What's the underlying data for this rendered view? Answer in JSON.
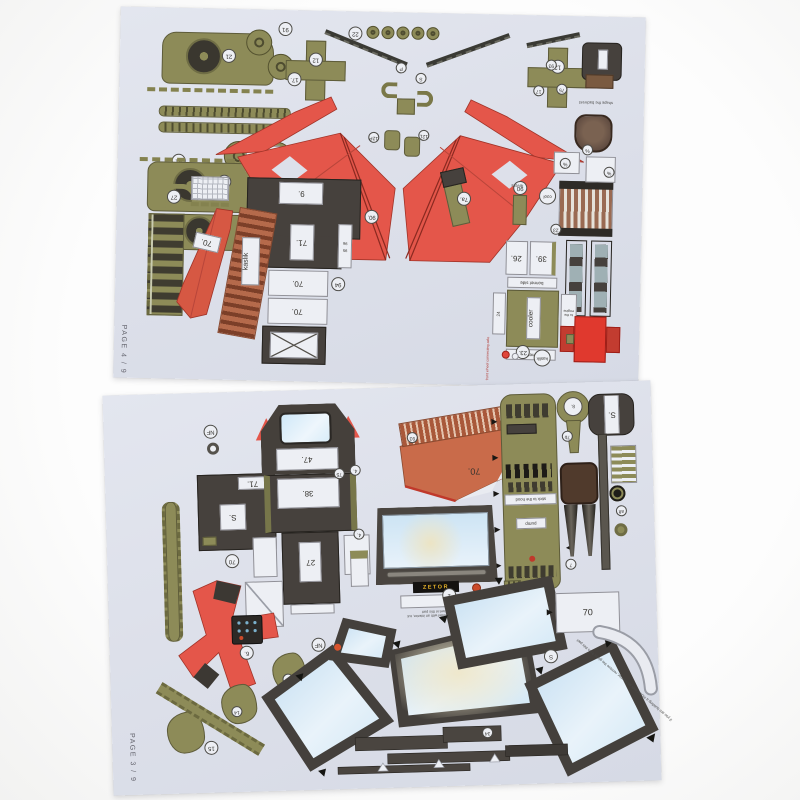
{
  "top_sheet": {
    "page_label": "PAGE 4 / 9",
    "boxes": {
      "engine9": "9.",
      "engine71": "71.",
      "engine70a": "70.",
      "engine70b": "70.",
      "wedge70": "70.",
      "grille26": "26.",
      "grille39": "39.",
      "side24": "24",
      "radiator_label": "kaslik",
      "cooler": "cooler",
      "bonnet_side_a": "bonnet side",
      "bonnet_side_b": "bonnet side",
      "to_engine": "to the engine",
      "levers": "levers",
      "seg96": "96",
      "seg95": "95"
    },
    "circles": {
      "c21a": "21",
      "c91a": "91",
      "c91b": "91",
      "c21b": "21",
      "c17a": "17.",
      "c12a": "12",
      "c22": "22",
      "cP": "P",
      "cS": "S",
      "c12p": "12P",
      "c12l": "12L",
      "c12b": "12",
      "c17b": "17",
      "c27": "27",
      "c90a": "90.",
      "c90b": "90",
      "c94": "94",
      "c7a": "7a.",
      "ccool": "cool",
      "c93": "93",
      "c75": "75",
      "c23a": "23",
      "c23b": "23.",
      "ckaslik": "kaslik",
      "cpct_a": "%",
      "cpct_b": "%",
      "cpct_c": "%"
    },
    "notes": {
      "shape_backrest": "shape the backrest",
      "front_axle": "front wheel connecting axle"
    }
  },
  "bottom_sheet": {
    "page_label": "PAGE 3 / 9",
    "boxes": {
      "cab47": "47.",
      "cab38": "38.",
      "cab27": "27",
      "box71": "71.",
      "boxS": "S.",
      "partS": "S.",
      "hood70": "70.",
      "right70": "70",
      "key8": "8."
    },
    "circles": {
      "cNF_a": "NF",
      "cNF_b": "NF",
      "c70": "70",
      "c93": "93",
      "c4": "4.",
      "c75": "75",
      "c6": "6.",
      "c14a": "14",
      "c14b": "14",
      "c15": "15",
      "c1": "1",
      "c7": "7",
      "c7b": "7b",
      "calt": "alt",
      "cS": "S",
      "c34": "34"
    },
    "labels": {
      "zetor": "ZETOR",
      "stick_hood": "stick to the hood",
      "pump": "pump"
    },
    "notes": {
      "windshield": "if you are building a model with an interior, cut out the windows in this part",
      "edge": "if you are building a model with an interior, remove the glass from this part"
    }
  },
  "colors": {
    "paper": "#dde0ea",
    "red": "#e4564a",
    "dark_red": "#a03328",
    "olive": "#8d8b58",
    "olive_dark": "#5e5c3a",
    "charcoal": "#46413d",
    "brown_ladder": "#b56a4b",
    "hood_orange": "#c96b4a",
    "glass_blue": "#cfe6f5",
    "glass_cream": "#ece4c4",
    "seat_brown": "#6b5242",
    "zetor_yellow": "#e8b428",
    "label_bg": "#edeff4"
  }
}
